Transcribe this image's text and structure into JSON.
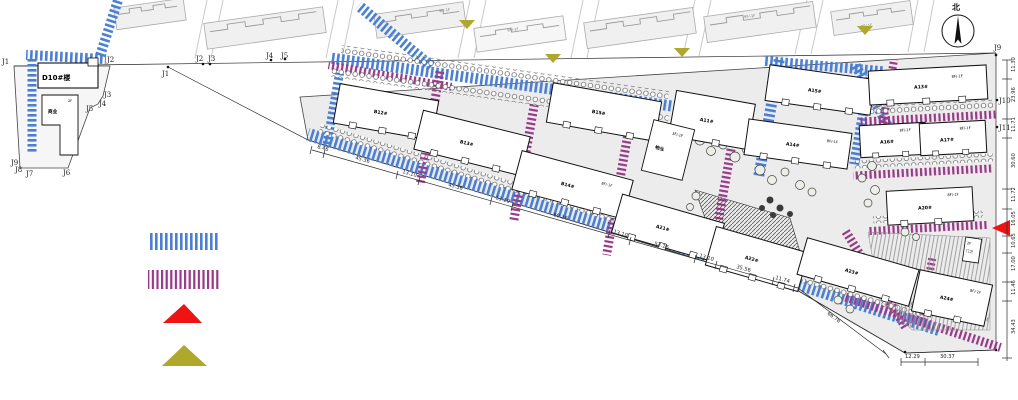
{
  "compass": {
    "label": "北"
  },
  "legend": {
    "items": [
      {
        "name": "primary-road-hatch",
        "color": "#4a7fd4"
      },
      {
        "name": "secondary-road-hatch",
        "color": "#993a88"
      },
      {
        "name": "main-entrance-marker",
        "color": "#ee1411"
      },
      {
        "name": "secondary-entrance-marker",
        "color": "#b0a82c"
      }
    ]
  },
  "buildings": {
    "d10": {
      "label": "D10#楼"
    },
    "shangye": {
      "label": "商业",
      "floors": "2F"
    },
    "b12": {
      "label": "B12#"
    },
    "b13": {
      "label": "B13#"
    },
    "b14": {
      "label": "B14#",
      "floors": "8F/-1F"
    },
    "b15": {
      "label": "B15#"
    },
    "a11": {
      "label": "A11#"
    },
    "a13": {
      "label": "A13#",
      "floors": "8F/-1F"
    },
    "a14": {
      "label": "A14#",
      "floors": "8F/-1F"
    },
    "a15": {
      "label": "A15#"
    },
    "a16": {
      "label": "A16#",
      "floors": "8F/-1F"
    },
    "a17": {
      "label": "A17#",
      "floors": "8F/-1F"
    },
    "a20": {
      "label": "A20#",
      "floors": "8F/-1F"
    },
    "a21": {
      "label": "A21#"
    },
    "a22": {
      "label": "A22#"
    },
    "a23": {
      "label": "A23#"
    },
    "a24": {
      "label": "A24#",
      "floors": "8F/-1F"
    },
    "wuye": {
      "label": "物业",
      "floors": "3F/-1F"
    },
    "guard": {
      "label": "门卫",
      "floors": "2F"
    }
  },
  "offsite": {
    "floor_label": "9F/-1F"
  },
  "junctions": {
    "left": [
      "J1",
      "J2",
      "J3",
      "J4",
      "J5",
      "J6",
      "J7",
      "J8",
      "J9"
    ],
    "boundary": [
      "J1",
      "J2",
      "J3",
      "J4",
      "J5"
    ],
    "right": [
      "J9",
      "J10",
      "J11"
    ]
  },
  "dimensions": {
    "bottom": [
      "8.46",
      "45.36",
      "13.10",
      "45.36",
      "13.10",
      "60.36",
      "13.10",
      "53.16",
      "13.10",
      "35.56",
      "11.74",
      "66.76"
    ],
    "bottom_right": [
      "12.29",
      "30.37"
    ],
    "right": [
      "11.30",
      "23.96",
      "11.71",
      "30.60",
      "11.72",
      "16.05",
      "10.65",
      "17.00",
      "11.46",
      "34.43"
    ]
  }
}
